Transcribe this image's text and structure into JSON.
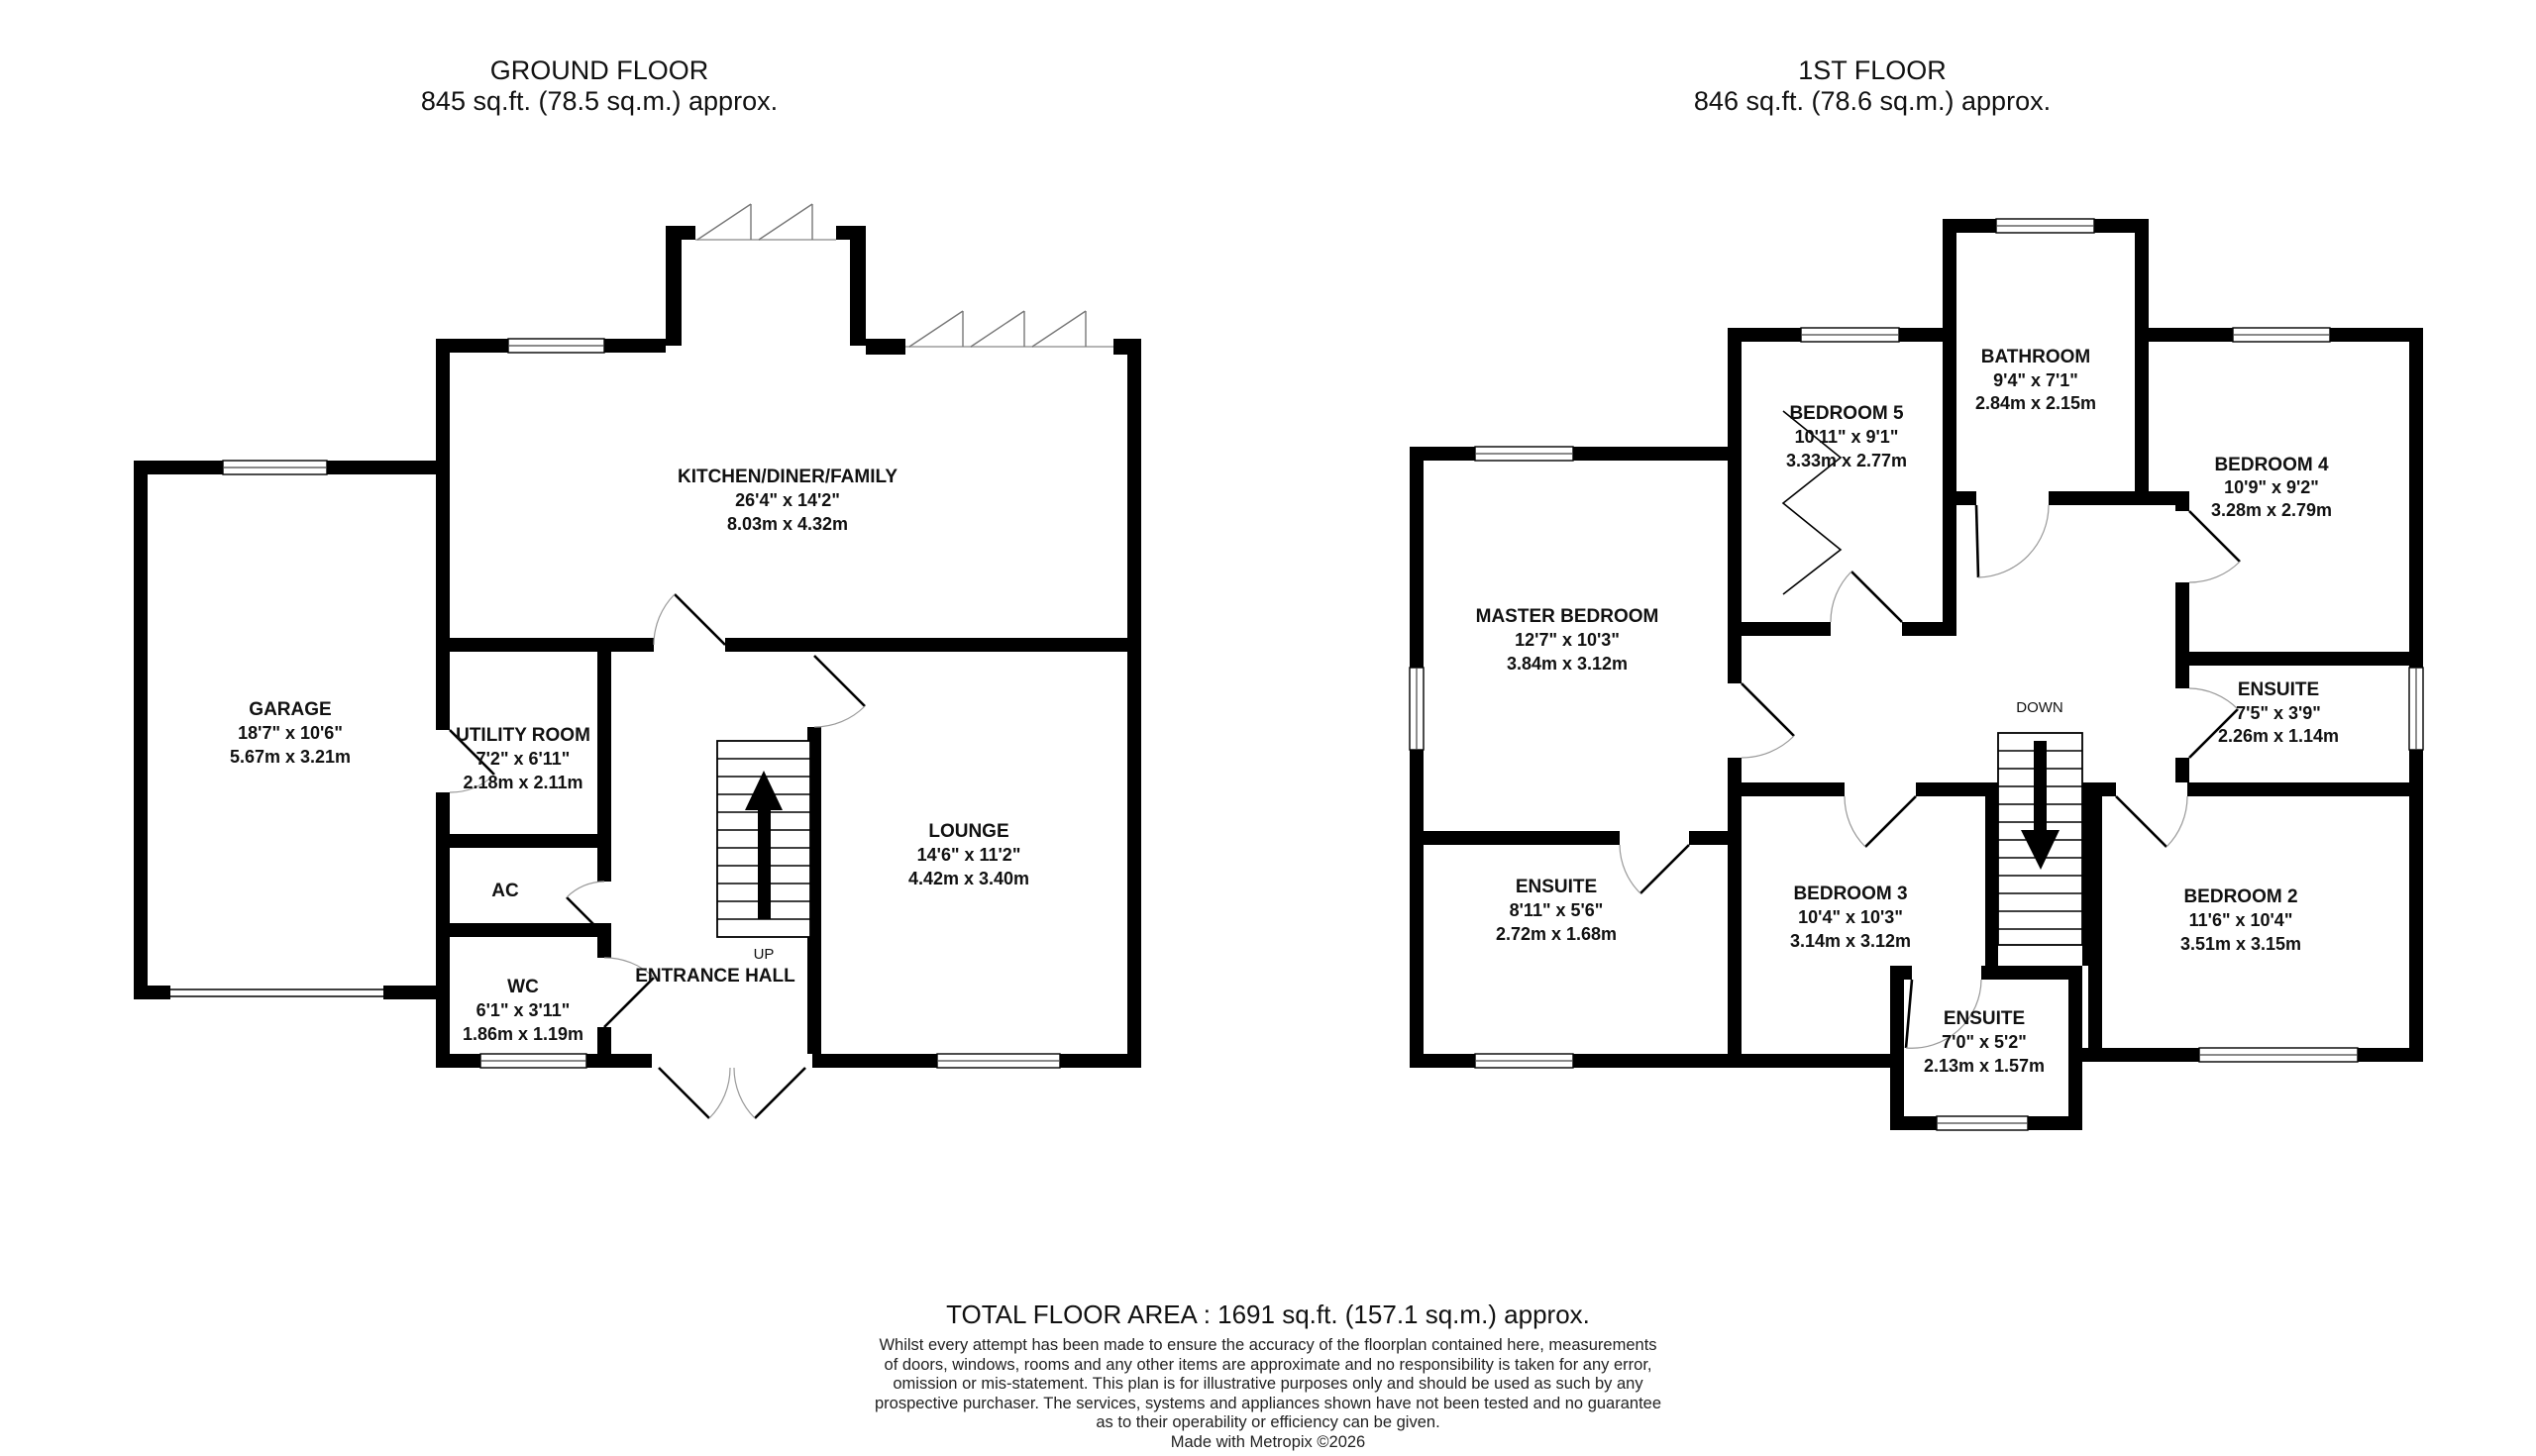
{
  "ground_floor": {
    "title": "GROUND FLOOR",
    "area": "845 sq.ft. (78.5 sq.m.) approx.",
    "stairs_label": "UP",
    "rooms": [
      {
        "name": "GARAGE",
        "dims_ft": "18'7\"  x 10'6\"",
        "dims_m": "5.67m  x 3.21m"
      },
      {
        "name": "KITCHEN/DINER/FAMILY",
        "dims_ft": "26'4\"  x 14'2\"",
        "dims_m": "8.03m  x 4.32m"
      },
      {
        "name": "UTILITY ROOM",
        "dims_ft": "7'2\"  x 6'11\"",
        "dims_m": "2.18m  x 2.11m"
      },
      {
        "name": "LOUNGE",
        "dims_ft": "14'6\"  x 11'2\"",
        "dims_m": "4.42m  x 3.40m"
      },
      {
        "name": "AC",
        "dims_ft": "",
        "dims_m": ""
      },
      {
        "name": "WC",
        "dims_ft": "6'1\"  x 3'11\"",
        "dims_m": "1.86m  x 1.19m"
      },
      {
        "name": "ENTRANCE HALL",
        "dims_ft": "",
        "dims_m": ""
      }
    ]
  },
  "first_floor": {
    "title": "1ST FLOOR",
    "area": "846 sq.ft. (78.6 sq.m.) approx.",
    "stairs_label": "DOWN",
    "rooms": [
      {
        "name": "MASTER BEDROOM",
        "dims_ft": "12'7\"  x 10'3\"",
        "dims_m": "3.84m  x 3.12m"
      },
      {
        "name": "BEDROOM 5",
        "dims_ft": "10'11\"  x 9'1\"",
        "dims_m": "3.33m  x 2.77m"
      },
      {
        "name": "BATHROOM",
        "dims_ft": "9'4\"  x 7'1\"",
        "dims_m": "2.84m  x 2.15m"
      },
      {
        "name": "BEDROOM 4",
        "dims_ft": "10'9\"  x 9'2\"",
        "dims_m": "3.28m  x 2.79m"
      },
      {
        "name": "ENSUITE",
        "dims_ft": "7'5\"  x 3'9\"",
        "dims_m": "2.26m  x 1.14m"
      },
      {
        "name": "ENSUITE",
        "dims_ft": "8'11\"  x 5'6\"",
        "dims_m": "2.72m  x 1.68m"
      },
      {
        "name": "BEDROOM 3",
        "dims_ft": "10'4\"  x 10'3\"",
        "dims_m": "3.14m  x 3.12m"
      },
      {
        "name": "BEDROOM 2",
        "dims_ft": "11'6\"  x 10'4\"",
        "dims_m": "3.51m  x 3.15m"
      },
      {
        "name": "ENSUITE",
        "dims_ft": "7'0\"  x 5'2\"",
        "dims_m": "2.13m  x 1.57m"
      }
    ]
  },
  "footer": {
    "total": "TOTAL FLOOR AREA : 1691 sq.ft. (157.1 sq.m.) approx.",
    "disclaimer_lines": [
      "Whilst every attempt has been made to ensure the accuracy of the floorplan contained here, measurements",
      "of doors, windows, rooms and any other items are approximate and no responsibility is taken for any error,",
      "omission or mis-statement. This plan is for illustrative purposes only and should be used as such by any",
      "prospective purchaser. The services, systems and appliances shown have not been tested and no guarantee",
      "as to their operability or efficiency can be given."
    ],
    "credit": "Made with Metropix ©2026"
  },
  "colors": {
    "wall": "#000000",
    "background": "#ffffff"
  }
}
